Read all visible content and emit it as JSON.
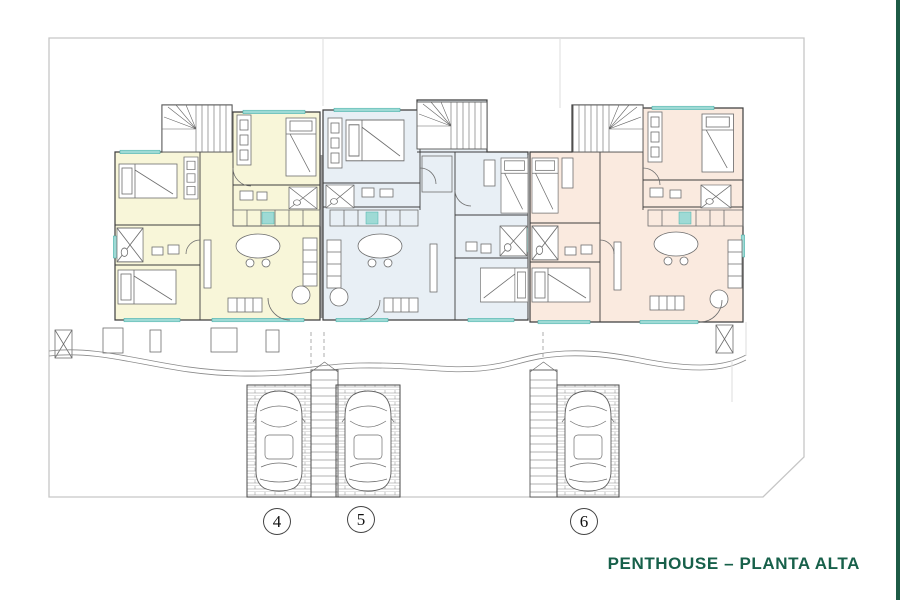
{
  "title": "PENTHOUSE – PLANTA ALTA",
  "units": [
    {
      "number": "4",
      "fill": "#f8f6d9"
    },
    {
      "number": "5",
      "fill": "#e8eff5"
    },
    {
      "number": "6",
      "fill": "#faeadf"
    }
  ],
  "colors": {
    "accent_green": "#17604a",
    "edge_bar_green": "#1d5b45",
    "window_teal": "#9edad5",
    "wall": "#3e3e3e",
    "boundary": "#c6c6c6",
    "paper": "#ffffff"
  }
}
